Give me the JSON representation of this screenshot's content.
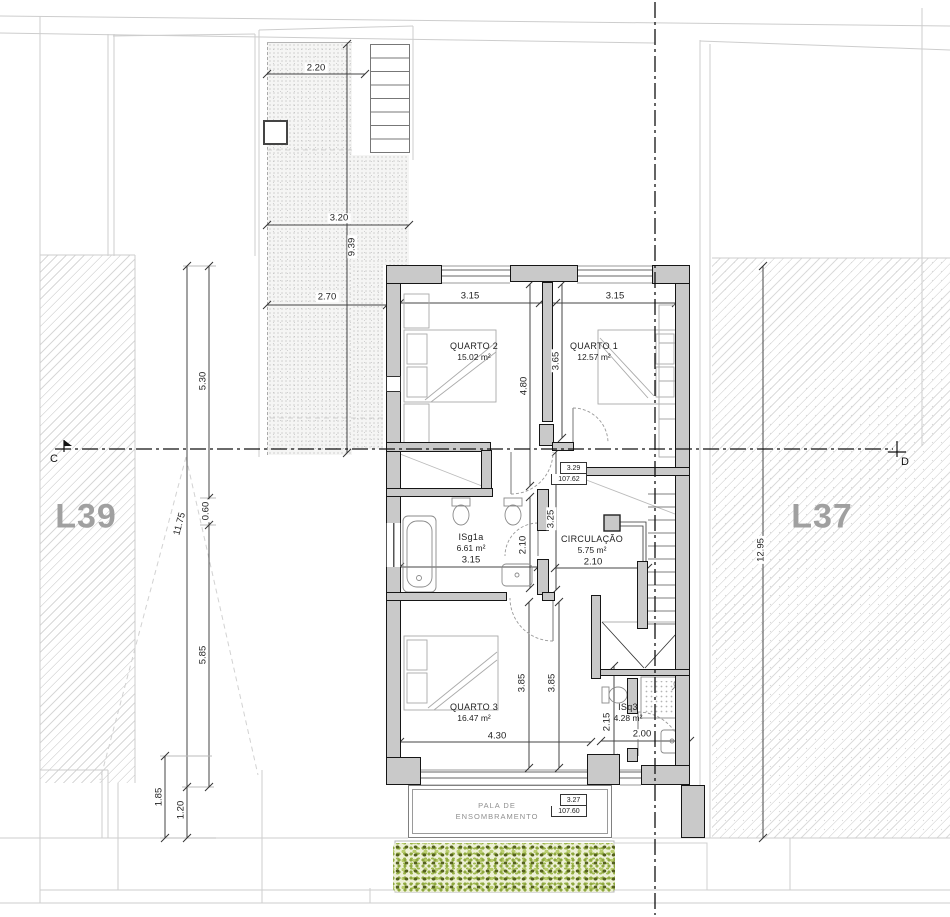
{
  "plan": {
    "lots": {
      "left_label": "L39",
      "right_label": "L37"
    },
    "section_markers": {
      "left": "C",
      "right": "D"
    },
    "rooms": {
      "quarto2": {
        "name": "QUARTO 2",
        "area": "15.02 m²"
      },
      "quarto1": {
        "name": "QUARTO 1",
        "area": "12.57 m²"
      },
      "isg1a": {
        "name": "ISg1a",
        "area": "6.61 m²"
      },
      "circulacao": {
        "name": "CIRCULAÇÃO",
        "area": "5.75 m²"
      },
      "quarto3": {
        "name": "QUARTO 3",
        "area": "16.47 m²"
      },
      "isq3": {
        "name": "ISq3",
        "area": "4.28 m²"
      }
    },
    "canopy": {
      "line1": "PALA DE",
      "line2": "ENSOMBRAMENTO"
    },
    "levels": {
      "hall": {
        "relative": "3.29",
        "absolute": "107.62"
      },
      "canopy": {
        "relative": "3.27",
        "absolute": "107.60"
      }
    },
    "dimensions": {
      "patio_top": "2.20",
      "patio_mid": "3.20",
      "patio_length": "9.39",
      "patio_low": "2.70",
      "west_upper": "5.30",
      "west_total": "11.75",
      "west_step": "0.60",
      "west_lower": "5.85",
      "sw_depth": "1.85",
      "sw_canopy": "1.20",
      "east_total": "12.95",
      "q2_width": "3.15",
      "q1_width": "3.15",
      "q2_depth": "4.80",
      "q1_depth": "3.65",
      "hall_depth": "3.25",
      "isg1a_depth": "2.10",
      "isg1a_width": "3.15",
      "circ_width": "2.10",
      "q3_depth_a": "3.85",
      "q3_depth_b": "3.85",
      "q3_width": "4.30",
      "isq3_depth": "2.15",
      "isq3_width": "2.00"
    },
    "colors": {
      "wall_fill": "#c9c9c9",
      "line": "#161616",
      "hatch": "#d8d8d8",
      "vegetation_light": "#b8cc6d",
      "vegetation_dark": "#55611f",
      "lot_label": "#a0a0a0"
    }
  }
}
